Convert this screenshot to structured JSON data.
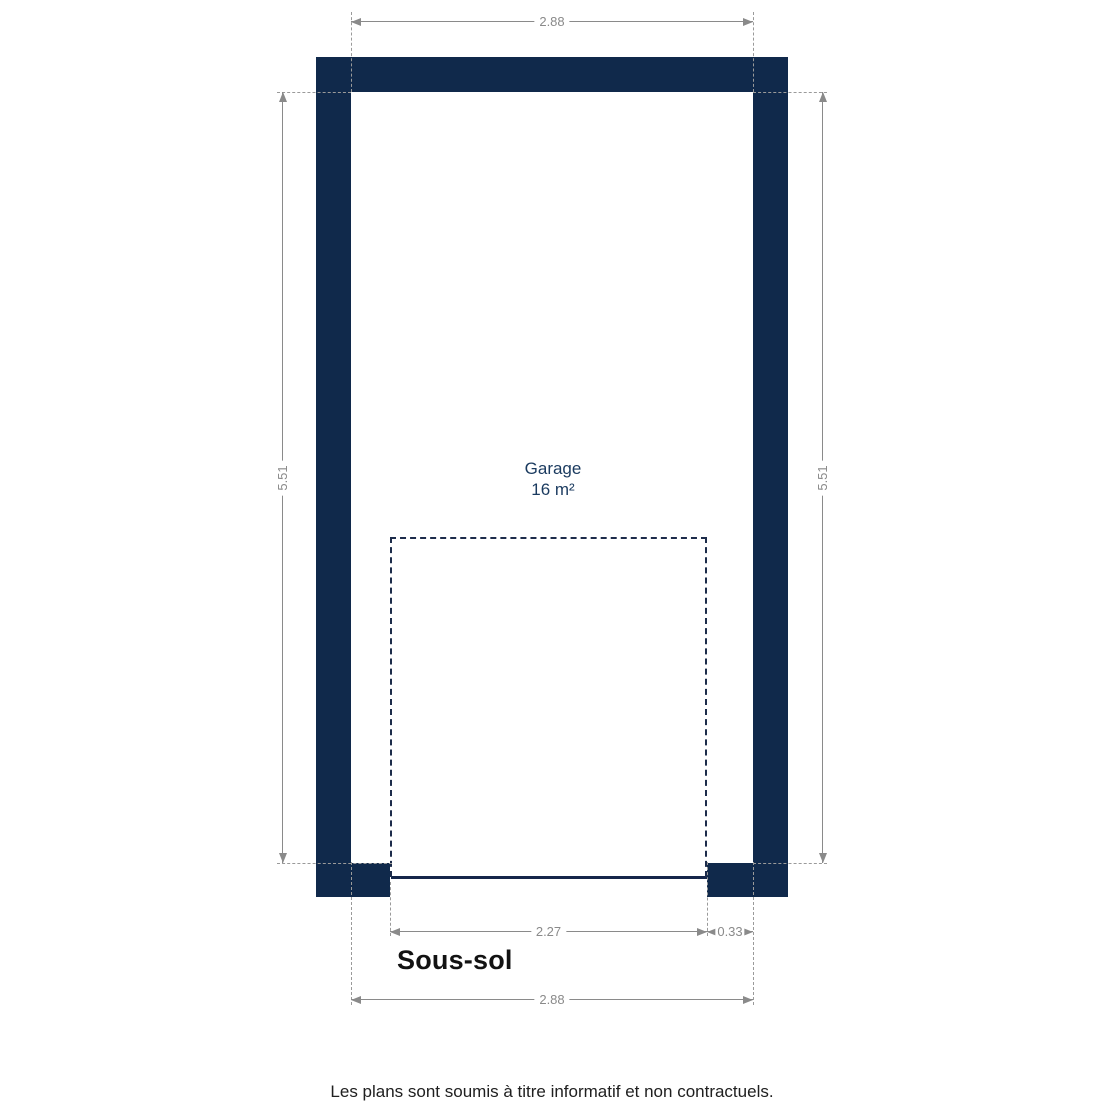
{
  "page": {
    "floor_title": "Sous-sol",
    "disclaimer": "Les plans sont soumis à titre informatif et non contractuels."
  },
  "room": {
    "name": "Garage",
    "area": "16 m²"
  },
  "dimensions": {
    "top_width_m": "2.88",
    "bottom_width_m": "2.88",
    "left_height_m": "5.51",
    "right_height_m": "5.51",
    "garage_door_width_m": "2.27",
    "right_wall_offset_m": "0.33"
  },
  "colors": {
    "wall_navy": "#10294b",
    "dimension_gray": "#8a8a8a",
    "room_label_navy": "#1a3a5f"
  }
}
